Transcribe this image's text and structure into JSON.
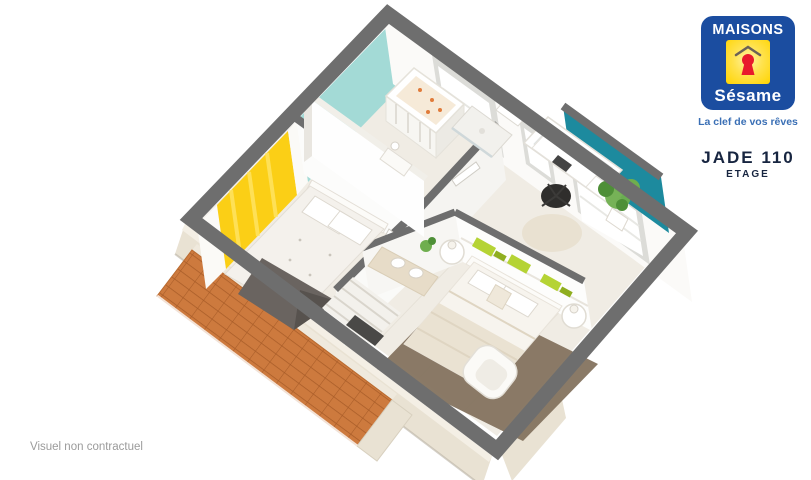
{
  "brand": {
    "name_top": "MAISONS",
    "name_script": "Sésame",
    "tagline": "La clef de vos rêves"
  },
  "plan": {
    "model": "JADE 110",
    "level": "ETAGE"
  },
  "footer": {
    "disclaimer": "Visuel non contractuel"
  },
  "palette": {
    "wall_top": "#6e6e6e",
    "floor": "#f0ece4",
    "accent_yellow": "#fbcf16",
    "teal_light": "#a3dad6",
    "teal_dark": "#1d8a9e",
    "roof_orange": "#cd7a3e",
    "roof_line": "#a85c28",
    "ext_beige": "#e9e2d3",
    "rug_brown": "#84735f",
    "plant_green": "#6fae4e",
    "shelf_green": "#b5d334",
    "throw_gray": "#6a6460",
    "logo_blue": "#1b4da0",
    "logo_yellow": "#ffd400",
    "logo_red": "#e8192c",
    "tagline_blue": "#3a6fb5",
    "plan_navy": "#172540",
    "muted": "#9b9b9b"
  }
}
